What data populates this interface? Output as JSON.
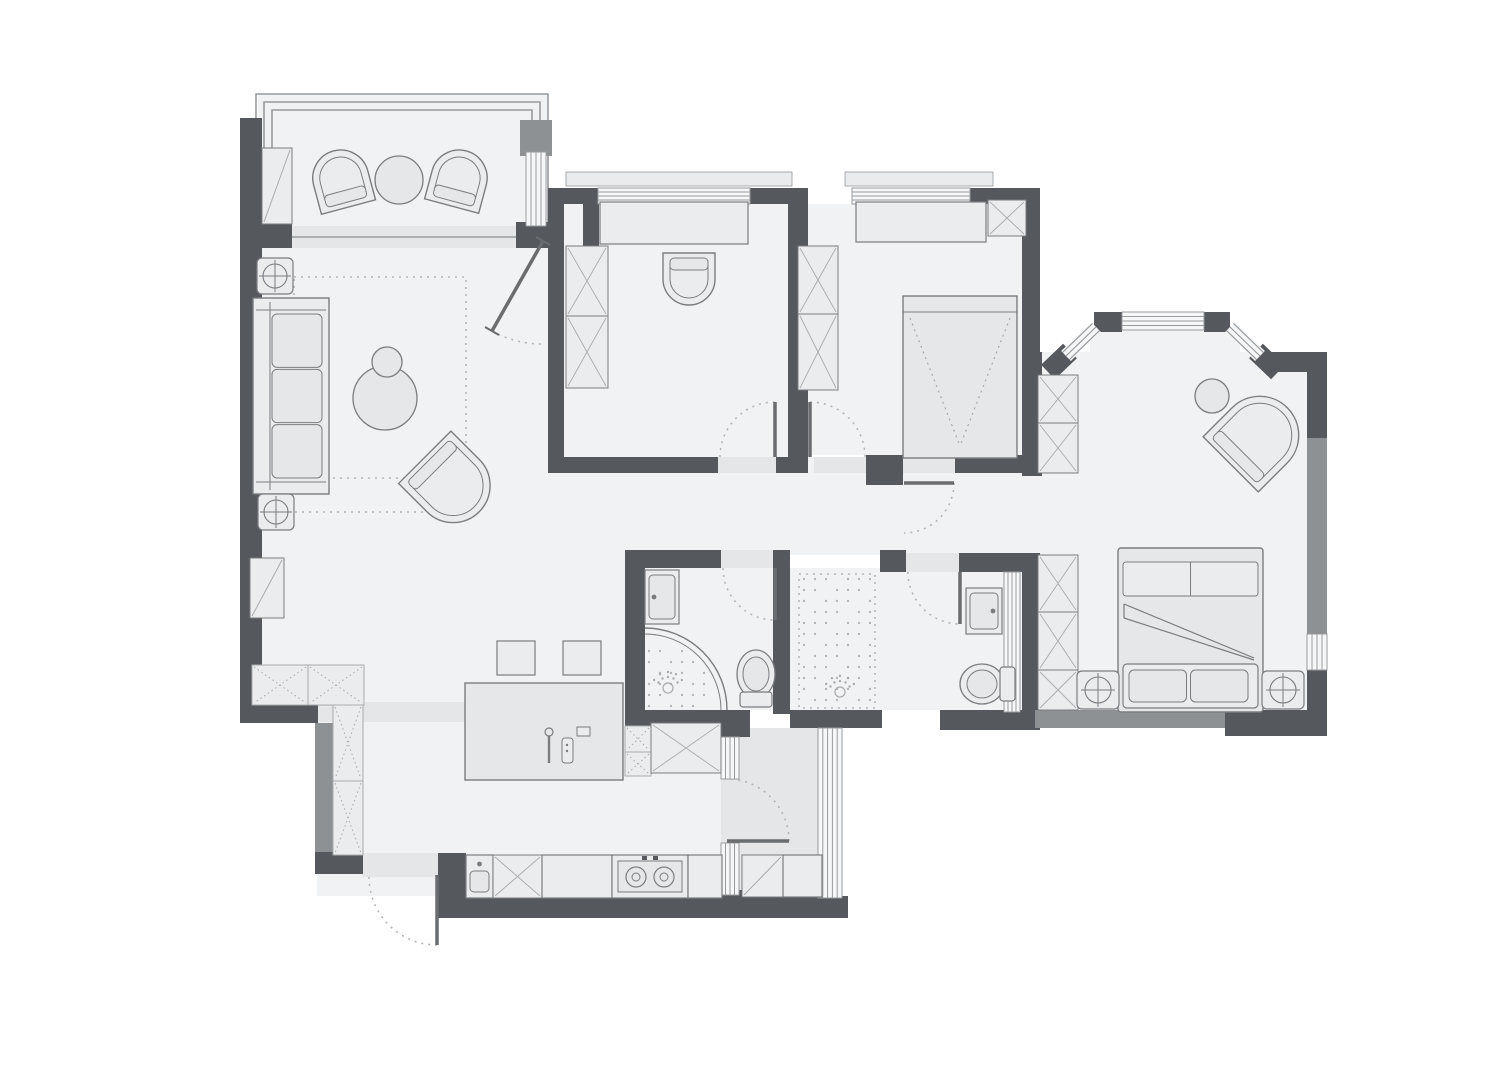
{
  "title": "apartment-floor-plan",
  "canvas": {
    "width": 1500,
    "height": 1069
  },
  "colors": {
    "bg": "#ffffff",
    "floor": "#f1f2f4",
    "floor_shade": "#e4e6e8",
    "ledge": "#e9ebed",
    "wall_dark": "#55585c",
    "wall_mid": "#8e9194",
    "furn_fill": "#ebecee",
    "furn_fill2": "#e6e7e9",
    "furn_stroke": "#7a7d80",
    "hatch": "#a8abae",
    "win_fill": "#f6f7f8",
    "win_line": "#989b9e",
    "dot": "#b4b7ba",
    "leaf": "#6a6d70"
  },
  "plan": {
    "floors": [
      {
        "name": "balcony-floor",
        "x": 258,
        "y": 94,
        "w": 290,
        "h": 136,
        "s": "f"
      },
      {
        "name": "living-room-floor",
        "x": 262,
        "y": 226,
        "w": 300,
        "h": 486,
        "s": "f"
      },
      {
        "name": "kitchen-dining-floor",
        "x": 317,
        "y": 555,
        "w": 408,
        "h": 341,
        "s": "f"
      },
      {
        "name": "study-floor",
        "x": 564,
        "y": 204,
        "w": 224,
        "h": 253,
        "s": "f"
      },
      {
        "name": "bedroom2-floor",
        "x": 808,
        "y": 204,
        "w": 214,
        "h": 251,
        "s": "f"
      },
      {
        "name": "corridor-floor",
        "x": 545,
        "y": 457,
        "w": 535,
        "h": 98,
        "s": "f"
      },
      {
        "name": "master-bedroom-floor",
        "x": 1040,
        "y": 352,
        "w": 267,
        "h": 360,
        "s": "f"
      },
      {
        "name": "bay-notch-floor",
        "x": 1090,
        "y": 330,
        "w": 150,
        "h": 26,
        "s": "f"
      },
      {
        "name": "bathroom1-floor",
        "x": 645,
        "y": 568,
        "w": 128,
        "h": 142,
        "s": "f"
      },
      {
        "name": "master-bath-floor",
        "x": 790,
        "y": 568,
        "w": 232,
        "h": 142,
        "s": "f"
      },
      {
        "name": "utility-balcony-floor",
        "x": 721,
        "y": 728,
        "w": 99,
        "h": 170,
        "s": "t"
      }
    ],
    "ledges": [
      {
        "x": 566,
        "y": 172,
        "w": 226,
        "h": 14
      },
      {
        "x": 845,
        "y": 172,
        "w": 148,
        "h": 14
      }
    ],
    "frames": [
      "M256,240 L256,94 L548,94 L548,240",
      "M264,240 L264,102 L540,102 L540,240",
      "M272,240 L272,110 L532,110 L532,240"
    ],
    "walls": [
      {
        "x": 240,
        "y": 118,
        "w": 22,
        "h": 594
      },
      {
        "x": 262,
        "y": 222,
        "w": 30,
        "h": 26
      },
      {
        "x": 516,
        "y": 222,
        "w": 32,
        "h": 26
      },
      {
        "x": 520,
        "y": 120,
        "w": 32,
        "h": 36,
        "s": "m"
      },
      {
        "x": 560,
        "y": 190,
        "w": 80,
        "h": 14
      },
      {
        "x": 583,
        "y": 204,
        "w": 16,
        "h": 44
      },
      {
        "x": 240,
        "y": 700,
        "w": 78,
        "h": 23
      },
      {
        "x": 315,
        "y": 723,
        "w": 18,
        "h": 131,
        "s": "m"
      },
      {
        "x": 315,
        "y": 852,
        "w": 48,
        "h": 22
      },
      {
        "x": 438,
        "y": 853,
        "w": 28,
        "h": 65
      },
      {
        "x": 450,
        "y": 896,
        "w": 398,
        "h": 22
      },
      {
        "x": 718,
        "y": 890,
        "w": 26,
        "h": 26
      },
      {
        "x": 548,
        "y": 188,
        "w": 16,
        "h": 285
      },
      {
        "x": 548,
        "y": 188,
        "w": 50,
        "h": 16
      },
      {
        "x": 750,
        "y": 188,
        "w": 58,
        "h": 16
      },
      {
        "x": 548,
        "y": 457,
        "w": 170,
        "h": 16
      },
      {
        "x": 776,
        "y": 457,
        "w": 12,
        "h": 16
      },
      {
        "x": 788,
        "y": 188,
        "w": 20,
        "h": 285
      },
      {
        "x": 970,
        "y": 188,
        "w": 70,
        "h": 16
      },
      {
        "x": 1022,
        "y": 188,
        "w": 18,
        "h": 170
      },
      {
        "x": 866,
        "y": 455,
        "w": 37,
        "h": 30
      },
      {
        "x": 955,
        "y": 455,
        "w": 82,
        "h": 18
      },
      {
        "x": 1022,
        "y": 352,
        "w": 20,
        "h": 124
      },
      {
        "x": 625,
        "y": 550,
        "w": 96,
        "h": 18
      },
      {
        "x": 625,
        "y": 550,
        "w": 20,
        "h": 180
      },
      {
        "x": 773,
        "y": 550,
        "w": 17,
        "h": 164
      },
      {
        "x": 880,
        "y": 550,
        "w": 26,
        "h": 22
      },
      {
        "x": 959,
        "y": 553,
        "w": 78,
        "h": 19
      },
      {
        "x": 1022,
        "y": 553,
        "w": 18,
        "h": 159
      },
      {
        "x": 625,
        "y": 710,
        "w": 100,
        "h": 22
      },
      {
        "x": 720,
        "y": 710,
        "w": 30,
        "h": 27
      },
      {
        "x": 790,
        "y": 710,
        "w": 92,
        "h": 18
      },
      {
        "x": 940,
        "y": 710,
        "w": 100,
        "h": 20
      },
      {
        "x": 1035,
        "y": 710,
        "w": 192,
        "h": 18,
        "s": "m"
      },
      {
        "x": 1225,
        "y": 710,
        "w": 102,
        "h": 26
      },
      {
        "x": 1266,
        "y": 352,
        "w": 61,
        "h": 20
      },
      {
        "x": 1307,
        "y": 352,
        "w": 20,
        "h": 86
      },
      {
        "x": 1307,
        "y": 438,
        "w": 20,
        "h": 198,
        "s": "m"
      },
      {
        "x": 1307,
        "y": 670,
        "w": 20,
        "h": 56
      },
      {
        "x": 1094,
        "y": 312,
        "w": 28,
        "h": 20
      },
      {
        "x": 1204,
        "y": 312,
        "w": 26,
        "h": 20
      }
    ],
    "stubs": [
      {
        "x1": 1048,
        "y1": 372,
        "x2": 1070,
        "y2": 351,
        "w": 20
      },
      {
        "x1": 1256,
        "y1": 351,
        "x2": 1278,
        "y2": 372,
        "w": 20
      }
    ],
    "diag_windows": [
      {
        "x1": 1066,
        "y1": 356,
        "x2": 1096,
        "y2": 327
      },
      {
        "x1": 1230,
        "y1": 327,
        "x2": 1260,
        "y2": 356
      }
    ],
    "windows": [
      {
        "name": "study-window",
        "x": 598,
        "y": 188,
        "w": 152,
        "h": 16,
        "o": "h",
        "n": 3
      },
      {
        "name": "bedroom2-window",
        "x": 852,
        "y": 188,
        "w": 118,
        "h": 16,
        "o": "h",
        "n": 3
      },
      {
        "name": "balcony-side-window",
        "x": 526,
        "y": 152,
        "w": 20,
        "h": 74,
        "o": "v",
        "n": 3
      },
      {
        "name": "bay-window-top",
        "x": 1122,
        "y": 312,
        "w": 82,
        "h": 18,
        "o": "h",
        "n": 3
      },
      {
        "name": "master-right-window",
        "x": 1307,
        "y": 634,
        "w": 20,
        "h": 36,
        "o": "v",
        "n": 3
      },
      {
        "name": "utility-glass-right",
        "x": 818,
        "y": 728,
        "w": 24,
        "h": 170,
        "o": "v",
        "n": 4
      },
      {
        "name": "utility-glass-upper",
        "x": 721,
        "y": 737,
        "w": 18,
        "h": 42,
        "o": "v",
        "n": 3
      },
      {
        "name": "utility-glass-lower",
        "x": 721,
        "y": 843,
        "w": 18,
        "h": 52,
        "o": "v",
        "n": 3
      },
      {
        "name": "master-bath-glass",
        "x": 1004,
        "y": 572,
        "w": 16,
        "h": 140,
        "o": "v",
        "n": 3
      }
    ],
    "thresholds": [
      {
        "x": 292,
        "y": 226,
        "w": 224,
        "h": 22
      },
      {
        "x": 718,
        "y": 457,
        "w": 58,
        "h": 16
      },
      {
        "x": 814,
        "y": 457,
        "w": 52,
        "h": 16
      },
      {
        "x": 903,
        "y": 455,
        "w": 52,
        "h": 18
      },
      {
        "x": 721,
        "y": 550,
        "w": 52,
        "h": 18
      },
      {
        "x": 906,
        "y": 553,
        "w": 53,
        "h": 19
      },
      {
        "x": 362,
        "y": 853,
        "w": 76,
        "h": 24
      },
      {
        "x": 317,
        "y": 702,
        "w": 230,
        "h": 20
      }
    ],
    "lines": [
      [
        292,
        237,
        516,
        237
      ]
    ],
    "doors": [
      {
        "name": "entry-door",
        "leaf": [
          437,
          875,
          437,
          945
        ],
        "arc": [
          369,
          877,
          437,
          945,
          68,
          0
        ]
      },
      {
        "name": "living-room-door",
        "leaf": [
          543,
          241,
          492,
          331
        ],
        "arc": [
          492,
          331,
          543,
          344,
          103,
          0
        ],
        "ticks": [
          [
            536,
            237,
            550,
            245
          ],
          [
            485,
            327,
            499,
            335
          ]
        ]
      },
      {
        "name": "study-door",
        "leaf": [
          775,
          402,
          775,
          457
        ],
        "arc": [
          720,
          457,
          775,
          402,
          55,
          1
        ]
      },
      {
        "name": "bedroom2-door",
        "leaf": [
          810,
          402,
          810,
          457
        ],
        "arc": [
          810,
          402,
          865,
          457,
          55,
          1
        ]
      },
      {
        "name": "master-suite-door",
        "leaf": [
          904,
          483,
          954,
          483
        ],
        "arc": [
          954,
          483,
          904,
          533,
          50,
          1
        ]
      },
      {
        "name": "bathroom1-door",
        "leaf": [
          775,
          568,
          775,
          620
        ],
        "arc": [
          723,
          568,
          775,
          620,
          52,
          0
        ]
      },
      {
        "name": "master-bath-door",
        "leaf": [
          960,
          572,
          960,
          624
        ],
        "arc": [
          908,
          572,
          960,
          624,
          52,
          0
        ]
      },
      {
        "name": "utility-door",
        "leaf": [
          727,
          841,
          789,
          841
        ],
        "arc": [
          789,
          841,
          727,
          779,
          62,
          0
        ]
      }
    ],
    "dot_rects": [
      {
        "name": "living-rug",
        "x": 294,
        "y": 277,
        "w": 172,
        "h": 201,
        "border": true,
        "dots": false
      },
      {
        "name": "walkin-shower-floor",
        "x": 799,
        "y": 574,
        "w": 76,
        "h": 134,
        "border": true,
        "dots": true
      },
      {
        "name": "island-top",
        "x": 528,
        "y": 708,
        "w": 92,
        "h": 62,
        "border": false,
        "dots": true
      }
    ],
    "dot_lines": [
      [
        295,
        512,
        458,
        512
      ]
    ],
    "furniture": [
      {
        "t": "fanchair",
        "name": "balcony-chair-left",
        "x": 313,
        "y": 150,
        "w": 56,
        "h": 58,
        "r": -15
      },
      {
        "t": "fanchair",
        "name": "balcony-chair-right",
        "x": 431,
        "y": 150,
        "w": 56,
        "h": 57,
        "r": 15
      },
      {
        "t": "circle",
        "name": "balcony-table",
        "cx": 399,
        "cy": 180,
        "r": 24
      },
      {
        "t": "dbox",
        "name": "balcony-cabinet",
        "x": 262,
        "y": 148,
        "w": 30,
        "h": 76
      },
      {
        "t": "lamp",
        "name": "side-table-lamp-top",
        "x": 257,
        "y": 258,
        "w": 36,
        "h": 36
      },
      {
        "t": "sofa",
        "name": "living-sofa",
        "x": 253,
        "y": 298,
        "w": 76,
        "h": 196
      },
      {
        "t": "lamp",
        "name": "side-table-lamp-bottom",
        "x": 258,
        "y": 494,
        "w": 36,
        "h": 36
      },
      {
        "t": "coffee",
        "name": "coffee-table",
        "cx": 385,
        "cy": 398,
        "r": 32,
        "cx2": 387,
        "cy2": 362,
        "r2": 15
      },
      {
        "t": "fanchair",
        "name": "living-armchair",
        "x": 415,
        "y": 446,
        "w": 74,
        "h": 77,
        "r": 135
      },
      {
        "t": "dbox",
        "name": "living-corner-cabinet",
        "x": 250,
        "y": 558,
        "w": 34,
        "h": 60
      },
      {
        "t": "dotx",
        "name": "kitchen-cabinet",
        "x": 252,
        "y": 665,
        "w": 56,
        "h": 40
      },
      {
        "t": "dotx",
        "name": "kitchen-cabinet",
        "x": 308,
        "y": 665,
        "w": 56,
        "h": 40
      },
      {
        "t": "dotx",
        "name": "kitchen-cabinet",
        "x": 333,
        "y": 705,
        "w": 30,
        "h": 76
      },
      {
        "t": "dotx",
        "name": "kitchen-cabinet",
        "x": 333,
        "y": 781,
        "w": 30,
        "h": 74
      },
      {
        "t": "box",
        "name": "study-desk",
        "x": 600,
        "y": 202,
        "w": 148,
        "h": 42
      },
      {
        "t": "fanchair",
        "name": "study-chair",
        "x": 663,
        "y": 253,
        "w": 52,
        "h": 52,
        "r": 180
      },
      {
        "t": "xbox",
        "name": "study-wardrobe",
        "x": 566,
        "y": 246,
        "w": 42,
        "h": 70
      },
      {
        "t": "xbox",
        "name": "study-wardrobe",
        "x": 566,
        "y": 316,
        "w": 42,
        "h": 72
      },
      {
        "t": "box",
        "name": "bedroom2-desk",
        "x": 856,
        "y": 202,
        "w": 130,
        "h": 40
      },
      {
        "t": "xbox",
        "name": "bedroom2-cabinet",
        "x": 988,
        "y": 200,
        "w": 38,
        "h": 36
      },
      {
        "t": "xbox",
        "name": "bedroom2-wardrobe",
        "x": 798,
        "y": 246,
        "w": 40,
        "h": 68
      },
      {
        "t": "xbox",
        "name": "bedroom2-wardrobe",
        "x": 798,
        "y": 314,
        "w": 40,
        "h": 76
      },
      {
        "t": "bedS",
        "name": "bedroom2-bed",
        "x": 903,
        "y": 296,
        "w": 114,
        "h": 162
      },
      {
        "t": "circle",
        "name": "master-side-table",
        "cx": 1212,
        "cy": 396,
        "r": 17
      },
      {
        "t": "fanchair",
        "name": "master-lounge-chair",
        "x": 1220,
        "y": 396,
        "w": 78,
        "h": 80,
        "r": 45
      },
      {
        "t": "xbox",
        "name": "master-wardrobe",
        "x": 1038,
        "y": 375,
        "w": 40,
        "h": 48
      },
      {
        "t": "xbox",
        "name": "master-wardrobe",
        "x": 1038,
        "y": 423,
        "w": 40,
        "h": 50
      },
      {
        "t": "xbox",
        "name": "master-wardrobe",
        "x": 1038,
        "y": 555,
        "w": 40,
        "h": 57
      },
      {
        "t": "xbox",
        "name": "master-wardrobe",
        "x": 1038,
        "y": 612,
        "w": 40,
        "h": 58
      },
      {
        "t": "xbox",
        "name": "master-wardrobe",
        "x": 1038,
        "y": 670,
        "w": 40,
        "h": 40
      },
      {
        "t": "bedD",
        "name": "master-bed",
        "x": 1118,
        "y": 548,
        "w": 145,
        "h": 164
      },
      {
        "t": "lamp",
        "name": "nightstand-left",
        "x": 1077,
        "y": 671,
        "w": 42,
        "h": 38
      },
      {
        "t": "lamp",
        "name": "nightstand-right",
        "x": 1262,
        "y": 671,
        "w": 42,
        "h": 38
      },
      {
        "t": "bsink",
        "name": "bathroom1-sink",
        "x": 645,
        "y": 570,
        "w": 34,
        "h": 54,
        "side": "l"
      },
      {
        "t": "cshower",
        "name": "bathroom1-corner-shower",
        "cx": 645,
        "cy": 710,
        "r": 82
      },
      {
        "t": "shead",
        "name": "bathroom1-shower-head",
        "cx": 668,
        "cy": 688
      },
      {
        "t": "toiletU",
        "name": "bathroom1-toilet",
        "x": 737,
        "y": 650,
        "w": 38,
        "h": 58
      },
      {
        "t": "shead",
        "name": "walkin-shower-head",
        "cx": 840,
        "cy": 692
      },
      {
        "t": "bsink",
        "name": "master-bath-sink",
        "x": 966,
        "y": 588,
        "w": 36,
        "h": 46,
        "side": "r"
      },
      {
        "t": "toiletL",
        "name": "master-bath-toilet",
        "x": 960,
        "y": 664,
        "w": 56,
        "h": 40
      },
      {
        "t": "island",
        "name": "kitchen-island",
        "x": 465,
        "y": 683,
        "w": 158,
        "h": 97
      },
      {
        "t": "box",
        "name": "island-stool",
        "x": 497,
        "y": 641,
        "w": 38,
        "h": 34
      },
      {
        "t": "box",
        "name": "island-stool",
        "x": 563,
        "y": 641,
        "w": 38,
        "h": 34
      },
      {
        "t": "dotx",
        "name": "bathroom-cabinet",
        "x": 625,
        "y": 726,
        "w": 26,
        "h": 26
      },
      {
        "t": "dotx",
        "name": "bathroom-cabinet",
        "x": 625,
        "y": 752,
        "w": 26,
        "h": 24
      },
      {
        "t": "xbox",
        "name": "tall-cabinet-fridge",
        "x": 651,
        "y": 723,
        "w": 70,
        "h": 50
      },
      {
        "t": "ksink",
        "name": "kitchen-sink",
        "x": 466,
        "y": 855,
        "w": 27,
        "h": 43
      },
      {
        "t": "xbox",
        "name": "kitchen-base-cabinet",
        "x": 493,
        "y": 855,
        "w": 49,
        "h": 43
      },
      {
        "t": "box",
        "name": "kitchen-counter",
        "x": 542,
        "y": 855,
        "w": 70,
        "h": 43
      },
      {
        "t": "cooktop",
        "name": "kitchen-cooktop",
        "x": 612,
        "y": 855,
        "w": 76,
        "h": 43
      },
      {
        "t": "box",
        "name": "kitchen-counter",
        "x": 688,
        "y": 855,
        "w": 34,
        "h": 43
      },
      {
        "t": "dbox",
        "name": "utility-cabinet",
        "x": 742,
        "y": 855,
        "w": 41,
        "h": 42
      },
      {
        "t": "box",
        "name": "utility-counter",
        "x": 783,
        "y": 855,
        "w": 39,
        "h": 42
      }
    ]
  }
}
